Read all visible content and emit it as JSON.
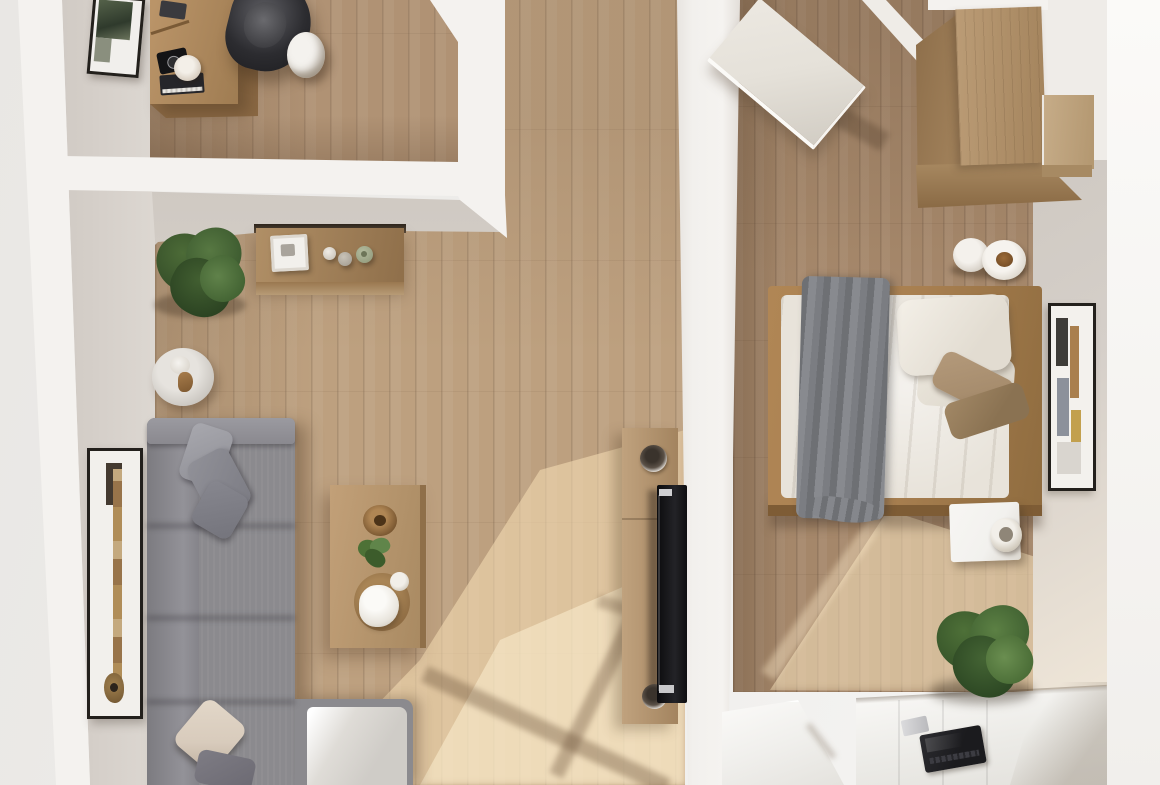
{
  "scene": {
    "title": "Apartment top-down 3D render",
    "type": "photoreal floor-plan render, bird's-eye view, no visible text",
    "rooms": [
      {
        "name": "office-nook",
        "position": "top-left",
        "furniture": [
          "wooden-desk",
          "desk-camera",
          "white-plate",
          "book-stack",
          "black-office-chair",
          "white-floor-mug",
          "wall-art-frame"
        ]
      },
      {
        "name": "living-room",
        "position": "left",
        "furniture": [
          "large-potted-plant",
          "wooden-console-table",
          "white-tray",
          "decor-bottles",
          "round-side-table",
          "gray-sectional-sofa",
          "gray-throw-pillows",
          "beige-throw-pillow",
          "chaise-cushion",
          "wooden-coffee-table",
          "wooden-bowl",
          "small-plant",
          "white-vase",
          "tall-driftwood-art-frame"
        ]
      },
      {
        "name": "hallway",
        "position": "center",
        "furniture": [
          "tv-console",
          "wall-mounted-tv",
          "round-speakers"
        ]
      },
      {
        "name": "bedroom",
        "position": "right",
        "furniture": [
          "open-white-door",
          "wooden-wardrobe",
          "wardrobe-side-unit",
          "double-bed",
          "gray-blanket",
          "white-pillows",
          "tan-folded-pillows",
          "coffee-cup-set",
          "framed-art",
          "white-nightstand",
          "nightstand-cup",
          "potted-plant",
          "white-desk",
          "laptop",
          "white-side-table"
        ]
      }
    ],
    "lighting": "warm sunlight entering from bottom windows casting diagonal window-frame shadows on wood floors"
  },
  "palette": {
    "bg_outer": "#e9e7e4",
    "wall_white": "#f4f2ef",
    "wall_face": "#d5cfc9",
    "divider": "#f2f0ed",
    "floor_main": "#bda07f",
    "floor_office": "#b09274",
    "floor_bedroom": "#a5876a",
    "sun_warm": "#f7ddb2",
    "shadow_warm": "#6f5640",
    "sofa_gray": "#8b8a8e",
    "sofa_cushion": "#cfccc7",
    "pillow_gray": "#9c9ca3",
    "pillow_beige": "#d8cbbc",
    "console_wood": "#a5845c",
    "coffee_table_wood": "#b5946c",
    "tv_black": "#121214",
    "bed_frame": "#a87f50",
    "bedding": "#e8e3da",
    "blanket_gray": "#7a7c81",
    "pillow_tan": "#a78d6e",
    "plant_green": "#3f5c31",
    "plant_green_light": "#5a7a40",
    "frame_black": "#23201c",
    "white_furniture": "#f2f1ee",
    "laptop_black": "#1b1b1e",
    "door_white": "#e5e1d9",
    "wardrobe_top": "#b3926c",
    "wardrobe_side": "#8d6e4a",
    "wardrobe_ext": "#c6ac88"
  }
}
